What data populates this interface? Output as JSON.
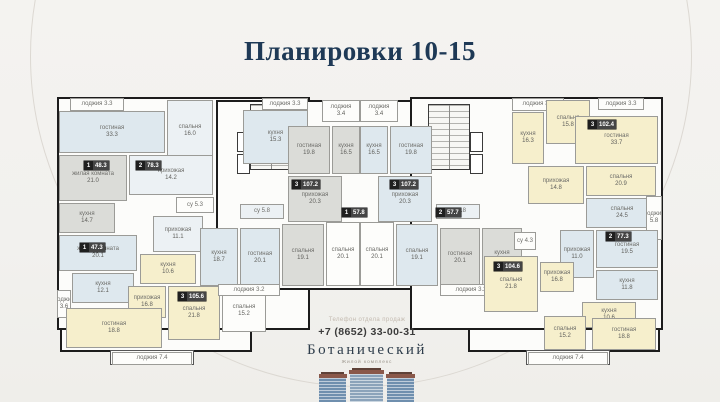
{
  "title": "Планировки 10-15",
  "contact": {
    "label": "Телефон отдела продаж",
    "phone": "+7 (8652) 33-00-31",
    "brand": "Ботанический",
    "brand_sub": "Жилой комплекс"
  },
  "colors": {
    "background": "#f3f2ef",
    "wall": "#1c1c1c",
    "title": "#1e3956",
    "blue": "#dee8ee",
    "yellow": "#f6efcc",
    "gray": "#dbdcd8",
    "white": "#fdfdfb",
    "pale": "#ecf1f4"
  },
  "floorplan": {
    "blocks": [
      {
        "name": "left-wing",
        "x": 57,
        "y": 97,
        "w": 253,
        "h": 233,
        "stroke": "thick"
      },
      {
        "name": "center-section",
        "x": 216,
        "y": 100,
        "w": 288,
        "h": 190,
        "stroke": "thick"
      },
      {
        "name": "right-wing",
        "x": 410,
        "y": 97,
        "w": 253,
        "h": 233,
        "stroke": "thick"
      },
      {
        "name": "left-lower-block",
        "x": 60,
        "y": 328,
        "w": 192,
        "h": 24,
        "stroke": "thick"
      },
      {
        "name": "right-lower-block",
        "x": 468,
        "y": 328,
        "w": 192,
        "h": 24,
        "stroke": "thick"
      },
      {
        "name": "left-balcony",
        "x": 110,
        "y": 350,
        "w": 84,
        "h": 15,
        "stroke": "thin"
      },
      {
        "name": "right-balcony",
        "x": 526,
        "y": 350,
        "w": 84,
        "h": 15,
        "stroke": "thin"
      }
    ],
    "cores": [
      {
        "name": "stair-core-left",
        "x": 250,
        "y": 104,
        "w": 42,
        "h": 66
      },
      {
        "name": "stair-core-right",
        "x": 428,
        "y": 104,
        "w": 42,
        "h": 66
      }
    ],
    "lifts": [
      {
        "x": 237,
        "y": 132,
        "w": 13,
        "h": 20
      },
      {
        "x": 237,
        "y": 154,
        "w": 13,
        "h": 20
      },
      {
        "x": 470,
        "y": 132,
        "w": 13,
        "h": 20
      },
      {
        "x": 470,
        "y": 154,
        "w": 13,
        "h": 20
      }
    ],
    "rooms": [
      {
        "id": "loggia-a",
        "label": "лоджия",
        "area": "3.3",
        "x": 70,
        "y": 98,
        "w": 54,
        "h": 13,
        "fill": "white"
      },
      {
        "id": "living-33-3",
        "label": "гостиная",
        "area": "33.3",
        "x": 59,
        "y": 111,
        "w": 106,
        "h": 42,
        "fill": "blue"
      },
      {
        "id": "bedroom-16-0",
        "label": "спальня",
        "area": "16.0",
        "x": 167,
        "y": 100,
        "w": 46,
        "h": 62,
        "fill": "pale"
      },
      {
        "id": "kitchen-15-3",
        "label": "кухня",
        "area": "15.3",
        "x": 243,
        "y": 110,
        "w": 65,
        "h": 54,
        "fill": "blue"
      },
      {
        "id": "loggia-b",
        "label": "лоджия",
        "area": "3.3",
        "x": 262,
        "y": 98,
        "w": 46,
        "h": 12,
        "fill": "white"
      },
      {
        "id": "room-21-0",
        "label": "жилая комната",
        "area": "21.0",
        "x": 59,
        "y": 155,
        "w": 68,
        "h": 46,
        "fill": "gray"
      },
      {
        "id": "hall-14-2",
        "label": "прихожая",
        "area": "14.2",
        "x": 129,
        "y": 155,
        "w": 84,
        "h": 40,
        "fill": "pale"
      },
      {
        "id": "kitchen-14-7",
        "label": "кухня",
        "area": "14.7",
        "x": 59,
        "y": 203,
        "w": 56,
        "h": 30,
        "fill": "gray"
      },
      {
        "id": "su-5-3",
        "label": "су",
        "area": "5.3",
        "x": 176,
        "y": 197,
        "w": 38,
        "h": 16,
        "fill": "white"
      },
      {
        "id": "room-20-1",
        "label": "жилая комната",
        "area": "20.1",
        "x": 59,
        "y": 235,
        "w": 78,
        "h": 36,
        "fill": "blue"
      },
      {
        "id": "hall-11-1",
        "label": "прихожая",
        "area": "11.1",
        "x": 153,
        "y": 216,
        "w": 50,
        "h": 36,
        "fill": "pale"
      },
      {
        "id": "kitchen-12-1",
        "label": "кухня",
        "area": "12.1",
        "x": 72,
        "y": 273,
        "w": 62,
        "h": 30,
        "fill": "blue"
      },
      {
        "id": "loggia-3-6",
        "label": "лоджия",
        "area": "3.6",
        "x": 57,
        "y": 290,
        "w": 14,
        "h": 28,
        "fill": "white"
      },
      {
        "id": "kitchen-10-6-l",
        "label": "кухня",
        "area": "10.6",
        "x": 140,
        "y": 254,
        "w": 56,
        "h": 30,
        "fill": "yellow"
      },
      {
        "id": "hall-16-8-l",
        "label": "прихожая",
        "area": "16.8",
        "x": 128,
        "y": 286,
        "w": 38,
        "h": 32,
        "fill": "yellow"
      },
      {
        "id": "bedroom-21-8-l",
        "label": "спальня",
        "area": "21.8",
        "x": 168,
        "y": 286,
        "w": 52,
        "h": 54,
        "fill": "yellow"
      },
      {
        "id": "bedroom-15-2-l",
        "label": "спальня",
        "area": "15.2",
        "x": 222,
        "y": 290,
        "w": 44,
        "h": 42,
        "fill": "white"
      },
      {
        "id": "living-18-8-l",
        "label": "гостиная",
        "area": "18.8",
        "x": 66,
        "y": 308,
        "w": 96,
        "h": 40,
        "fill": "yellow"
      },
      {
        "id": "loggia-7-4-l",
        "label": "лоджия",
        "area": "7.4",
        "x": 112,
        "y": 352,
        "w": 80,
        "h": 13,
        "fill": "white"
      },
      {
        "id": "loggia-3-4-l",
        "label": "лоджия",
        "area": "3.4",
        "x": 322,
        "y": 100,
        "w": 38,
        "h": 22,
        "fill": "white"
      },
      {
        "id": "loggia-3-4-r",
        "label": "лоджия",
        "area": "3.4",
        "x": 360,
        "y": 100,
        "w": 38,
        "h": 22,
        "fill": "white"
      },
      {
        "id": "living-19-8-l",
        "label": "гостиная",
        "area": "19.8",
        "x": 288,
        "y": 126,
        "w": 42,
        "h": 48,
        "fill": "gray"
      },
      {
        "id": "kitchen-16-5-l",
        "label": "кухня",
        "area": "16.5",
        "x": 332,
        "y": 126,
        "w": 28,
        "h": 48,
        "fill": "gray"
      },
      {
        "id": "hall-20-3-l",
        "label": "прихожая",
        "area": "20.3",
        "x": 288,
        "y": 176,
        "w": 54,
        "h": 46,
        "fill": "gray"
      },
      {
        "id": "living-19-8-r",
        "label": "гостиная",
        "area": "19.8",
        "x": 390,
        "y": 126,
        "w": 42,
        "h": 48,
        "fill": "blue"
      },
      {
        "id": "kitchen-16-5-r",
        "label": "кухня",
        "area": "16.5",
        "x": 360,
        "y": 126,
        "w": 28,
        "h": 48,
        "fill": "blue"
      },
      {
        "id": "hall-20-3-r",
        "label": "прихожая",
        "area": "20.3",
        "x": 378,
        "y": 176,
        "w": 54,
        "h": 46,
        "fill": "blue"
      },
      {
        "id": "su-5-8-l",
        "label": "су",
        "area": "5.8",
        "x": 240,
        "y": 204,
        "w": 44,
        "h": 15,
        "fill": "pale"
      },
      {
        "id": "su-5-8-r",
        "label": "су",
        "area": "5.8",
        "x": 436,
        "y": 204,
        "w": 44,
        "h": 15,
        "fill": "pale"
      },
      {
        "id": "kitchen-18-7-l",
        "label": "кухня",
        "area": "18.7",
        "x": 200,
        "y": 228,
        "w": 38,
        "h": 58,
        "fill": "blue"
      },
      {
        "id": "living-20-1-l",
        "label": "гостиная",
        "area": "20.1",
        "x": 240,
        "y": 228,
        "w": 40,
        "h": 60,
        "fill": "blue"
      },
      {
        "id": "bedroom-19-1-l",
        "label": "спальня",
        "area": "19.1",
        "x": 282,
        "y": 224,
        "w": 42,
        "h": 62,
        "fill": "gray"
      },
      {
        "id": "bedroom-20-1-wl",
        "label": "спальня",
        "area": "20.1",
        "x": 326,
        "y": 222,
        "w": 34,
        "h": 64,
        "fill": "white"
      },
      {
        "id": "bedroom-20-1-wr",
        "label": "спальня",
        "area": "20.1",
        "x": 360,
        "y": 222,
        "w": 34,
        "h": 64,
        "fill": "white"
      },
      {
        "id": "bedroom-19-1-r",
        "label": "спальня",
        "area": "19.1",
        "x": 396,
        "y": 224,
        "w": 42,
        "h": 62,
        "fill": "blue"
      },
      {
        "id": "living-20-1-r",
        "label": "гостиная",
        "area": "20.1",
        "x": 440,
        "y": 228,
        "w": 40,
        "h": 60,
        "fill": "gray"
      },
      {
        "id": "kitchen-18-7-r",
        "label": "кухня",
        "area": "18.7",
        "x": 482,
        "y": 228,
        "w": 40,
        "h": 58,
        "fill": "gray"
      },
      {
        "id": "loggia-3-2-l",
        "label": "лоджия",
        "area": "3.2",
        "x": 218,
        "y": 284,
        "w": 62,
        "h": 12,
        "fill": "white"
      },
      {
        "id": "loggia-3-2-r",
        "label": "лоджия",
        "area": "3.2",
        "x": 440,
        "y": 284,
        "w": 62,
        "h": 12,
        "fill": "white"
      },
      {
        "id": "loggia-3-7",
        "label": "лоджия",
        "area": "3.7",
        "x": 512,
        "y": 98,
        "w": 52,
        "h": 13,
        "fill": "white"
      },
      {
        "id": "loggia-c",
        "label": "лоджия",
        "area": "3.3",
        "x": 598,
        "y": 98,
        "w": 46,
        "h": 12,
        "fill": "white"
      },
      {
        "id": "kitchen-16-3",
        "label": "кухня",
        "area": "16.3",
        "x": 512,
        "y": 112,
        "w": 32,
        "h": 52,
        "fill": "yellow"
      },
      {
        "id": "bedroom-15-8",
        "label": "спальня",
        "area": "15.8",
        "x": 546,
        "y": 100,
        "w": 44,
        "h": 44,
        "fill": "yellow"
      },
      {
        "id": "living-33-7",
        "label": "гостиная",
        "area": "33.7",
        "x": 575,
        "y": 116,
        "w": 83,
        "h": 48,
        "fill": "yellow"
      },
      {
        "id": "hall-14-8",
        "label": "прихожая",
        "area": "14.8",
        "x": 528,
        "y": 166,
        "w": 56,
        "h": 38,
        "fill": "yellow"
      },
      {
        "id": "bedroom-20-9",
        "label": "спальня",
        "area": "20.9",
        "x": 586,
        "y": 166,
        "w": 70,
        "h": 30,
        "fill": "yellow"
      },
      {
        "id": "su-4-3",
        "label": "су",
        "area": "4.3",
        "x": 514,
        "y": 232,
        "w": 22,
        "h": 18,
        "fill": "white"
      },
      {
        "id": "bedroom-24-5",
        "label": "спальня",
        "area": "24.5",
        "x": 586,
        "y": 198,
        "w": 72,
        "h": 30,
        "fill": "blue"
      },
      {
        "id": "loggia-5-8",
        "label": "лоджия",
        "area": "5.8",
        "x": 646,
        "y": 196,
        "w": 16,
        "h": 44,
        "fill": "white"
      },
      {
        "id": "hall-11-0",
        "label": "прихожая",
        "area": "11.0",
        "x": 560,
        "y": 230,
        "w": 34,
        "h": 48,
        "fill": "blue"
      },
      {
        "id": "living-19-5",
        "label": "гостиная",
        "area": "19.5",
        "x": 596,
        "y": 230,
        "w": 62,
        "h": 38,
        "fill": "blue"
      },
      {
        "id": "kitchen-11-8",
        "label": "кухня",
        "area": "11.8",
        "x": 596,
        "y": 270,
        "w": 62,
        "h": 30,
        "fill": "blue"
      },
      {
        "id": "bedroom-21-8-r",
        "label": "спальня",
        "area": "21.8",
        "x": 484,
        "y": 256,
        "w": 54,
        "h": 56,
        "fill": "yellow"
      },
      {
        "id": "hall-16-8-r",
        "label": "прихожая",
        "area": "16.8",
        "x": 540,
        "y": 262,
        "w": 34,
        "h": 30,
        "fill": "yellow"
      },
      {
        "id": "kitchen-10-6-r",
        "label": "кухня",
        "area": "10.6",
        "x": 582,
        "y": 302,
        "w": 54,
        "h": 26,
        "fill": "yellow"
      },
      {
        "id": "bedroom-15-2-r",
        "label": "спальня",
        "area": "15.2",
        "x": 544,
        "y": 316,
        "w": 42,
        "h": 34,
        "fill": "yellow"
      },
      {
        "id": "living-18-8-r",
        "label": "гостиная",
        "area": "18.8",
        "x": 592,
        "y": 318,
        "w": 64,
        "h": 32,
        "fill": "yellow"
      },
      {
        "id": "loggia-7-4-r",
        "label": "лоджия",
        "area": "7.4",
        "x": 528,
        "y": 352,
        "w": 80,
        "h": 13,
        "fill": "white"
      }
    ],
    "badges": [
      {
        "num": "1",
        "area": "48.3",
        "x": 84,
        "y": 161
      },
      {
        "num": "2",
        "area": "78.3",
        "x": 136,
        "y": 161
      },
      {
        "num": "1",
        "area": "47.3",
        "x": 80,
        "y": 243
      },
      {
        "num": "3",
        "area": "105.6",
        "x": 178,
        "y": 292
      },
      {
        "num": "3",
        "area": "107.2",
        "x": 292,
        "y": 180
      },
      {
        "num": "3",
        "area": "107.2",
        "x": 390,
        "y": 180
      },
      {
        "num": "1",
        "area": "57.8",
        "x": 342,
        "y": 208
      },
      {
        "num": "2",
        "area": "57.7",
        "x": 436,
        "y": 208
      },
      {
        "num": "3",
        "area": "102.4",
        "x": 588,
        "y": 120
      },
      {
        "num": "2",
        "area": "77.3",
        "x": 606,
        "y": 232
      },
      {
        "num": "3",
        "area": "104.6",
        "x": 494,
        "y": 262
      }
    ]
  }
}
